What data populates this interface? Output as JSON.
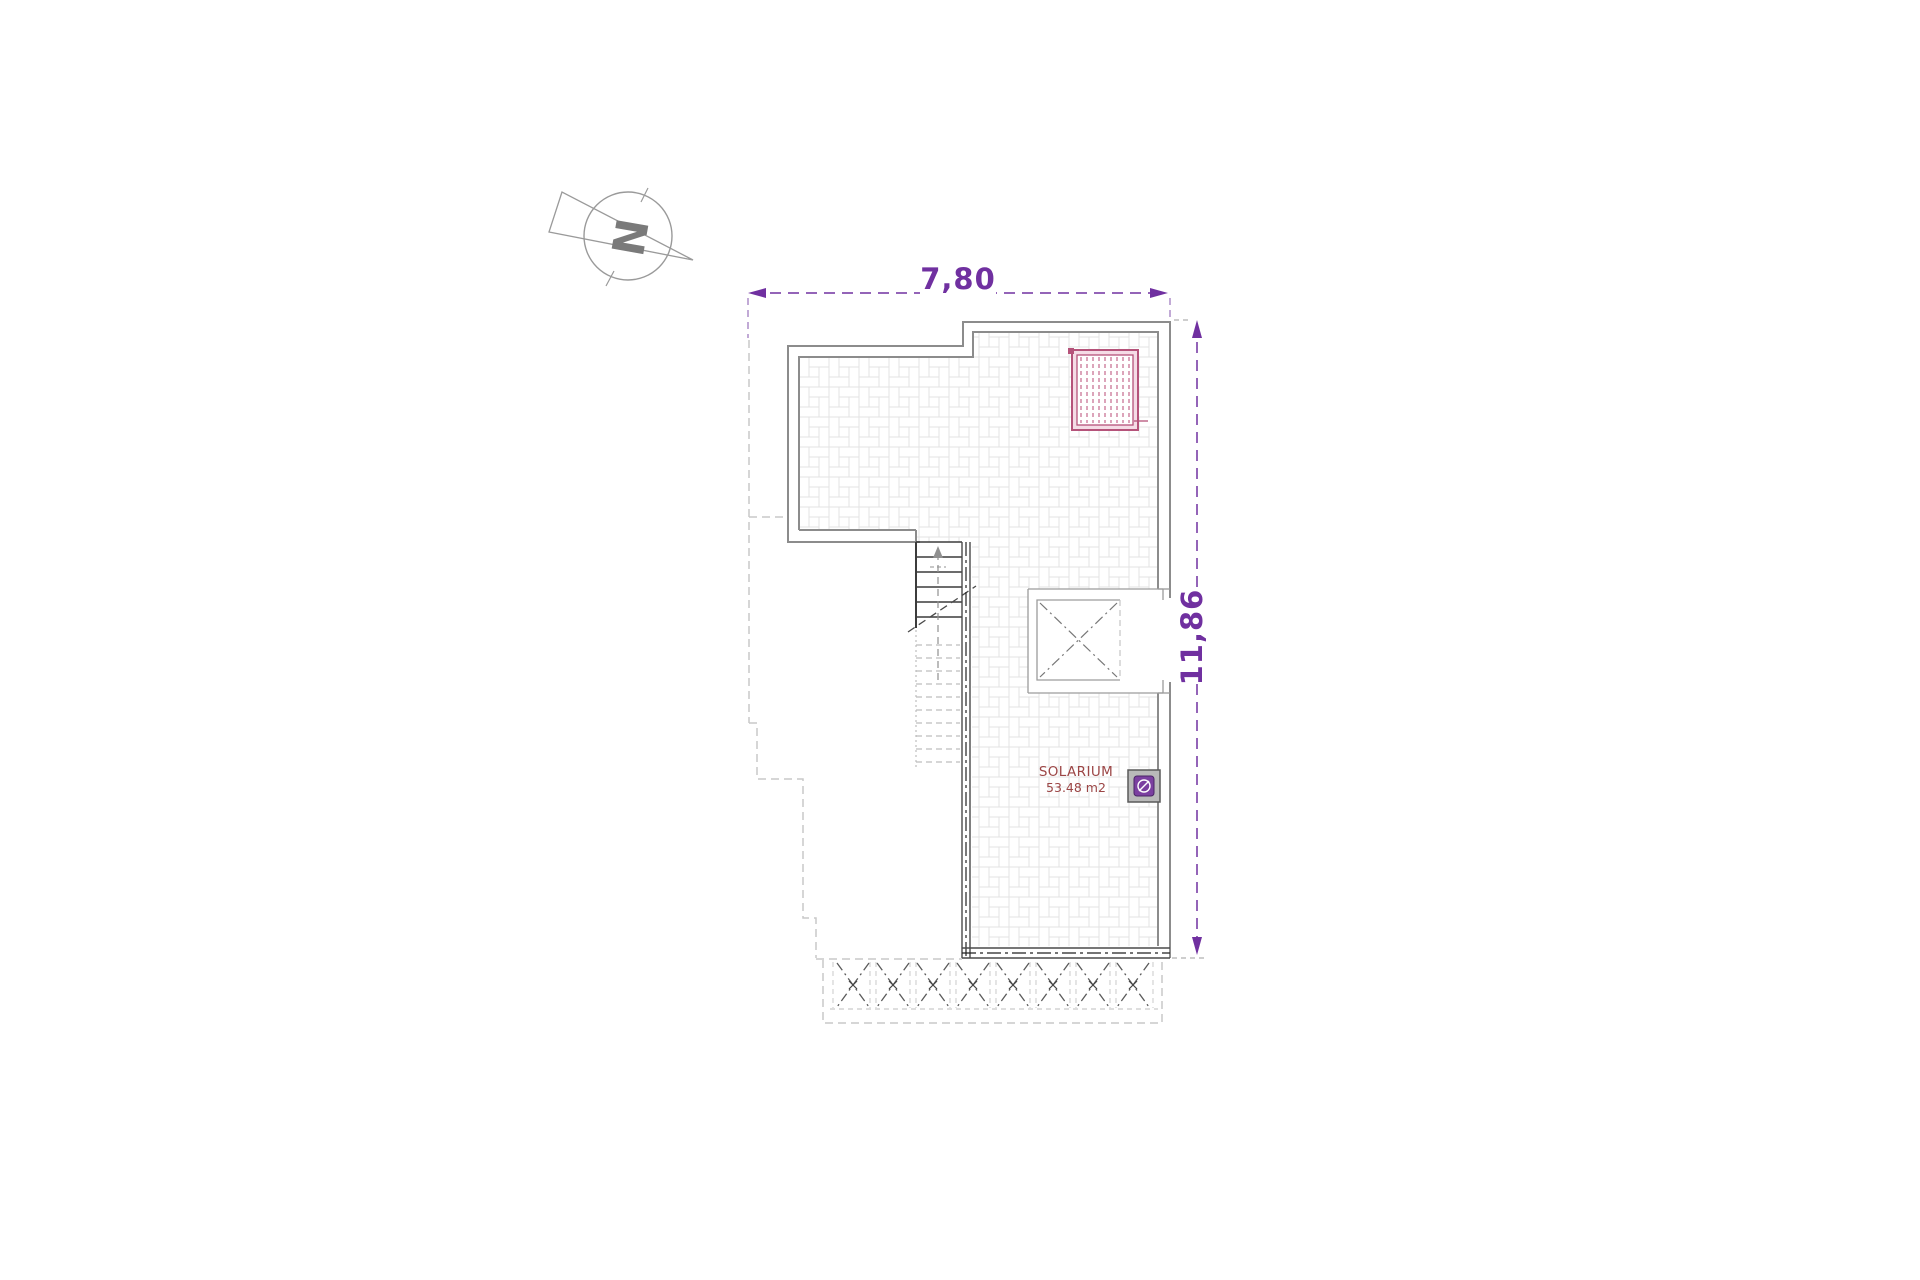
{
  "north_indicator": {
    "letter": "N"
  },
  "dimensions": {
    "width_label": "7,80",
    "height_label": "11,86",
    "color": "#7030a0"
  },
  "room": {
    "name": "SOLARIUM",
    "area": "53.48 m2",
    "label_color": "#9c4646"
  },
  "features": {
    "pergola_grill_icon": "pink hatched roof grill",
    "void_shaft_icon": "crossed roof void",
    "fence_panel_count": 8,
    "light_fixture_icon": "purple spot on grey base"
  },
  "palette": {
    "wall_gray": "#8c8c8c",
    "cut_dark": "#3c3c3c",
    "tile_line": "#e3e3e3",
    "dashed_outline": "#c9c9c9",
    "grill_pink": "#b5537a",
    "fixture_purple": "#7b3fa0",
    "compass_gray": "#9a9a9a"
  }
}
